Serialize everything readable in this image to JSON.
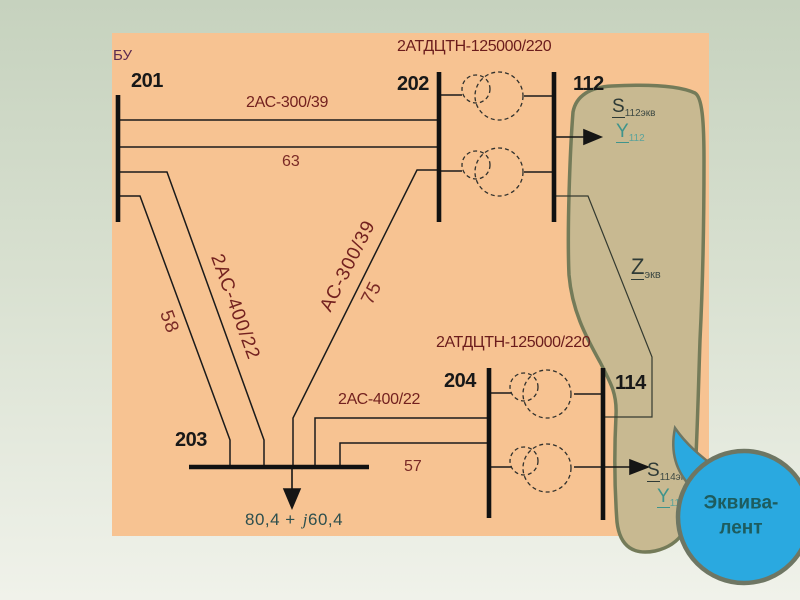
{
  "slide": {
    "background_top": "#c6d2be",
    "background_bottom": "#f0f2ea",
    "panel_color": "#f7c392"
  },
  "bu_label": "БУ",
  "buses": {
    "b201": "201",
    "b202": "202",
    "b112": "112",
    "b203": "203",
    "b204": "204",
    "b114": "114"
  },
  "lines": {
    "l201_202": {
      "name": "2АС-300/39",
      "length": "63"
    },
    "l201_203": {
      "name": "2АС-400/22",
      "length": "58"
    },
    "l202_203": {
      "name": "АС-300/39",
      "length": "75"
    },
    "l203_204": {
      "name": "2АС-400/22",
      "length": "57"
    }
  },
  "transformers": {
    "t_top": "2АТДЦТН-125000/220",
    "t_bottom": "2АТДЦТН-125000/220"
  },
  "load": {
    "real": "80,4 +",
    "j": "j",
    "imag": "60,4"
  },
  "equivalent": {
    "s112": {
      "sym": "S",
      "sub": "112экв"
    },
    "y112": {
      "sym": "Y",
      "sub": "112"
    },
    "z": {
      "sym": "Z",
      "sub": "экв"
    },
    "s114": {
      "sym": "S",
      "sub": "114экв"
    },
    "y114": {
      "sym": "Y",
      "sub": "114"
    },
    "region_fill": "#c8b991",
    "region_stroke": "#747b59"
  },
  "bubble": {
    "line1": "Эквива-",
    "line2": "лент",
    "fill": "#2aa9e0",
    "stroke": "#6e7663",
    "text_color": "#1d5c5e"
  }
}
